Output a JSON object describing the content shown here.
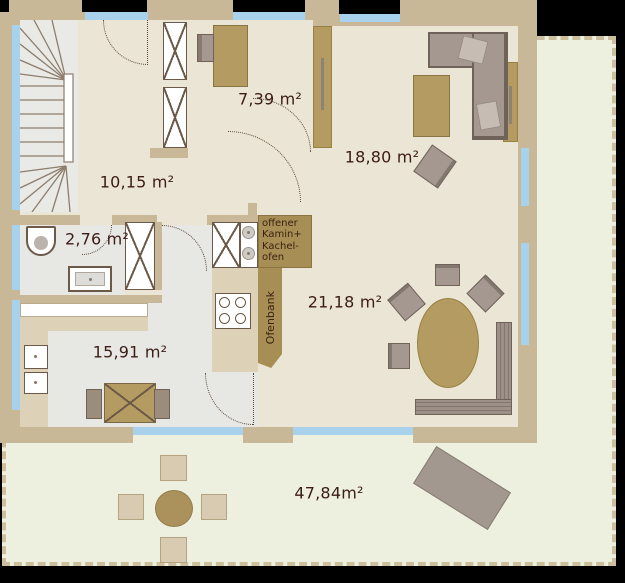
{
  "plan": {
    "title": "floor-plan",
    "rooms": [
      {
        "id": "hallway",
        "area_label": "10,15 m²"
      },
      {
        "id": "office",
        "area_label": "7,39 m²"
      },
      {
        "id": "living-room",
        "area_label": "18,80 m²"
      },
      {
        "id": "bathroom",
        "area_label": "2,76 m²"
      },
      {
        "id": "kitchen",
        "area_label": "15,91 m²"
      },
      {
        "id": "dining-room",
        "area_label": "21,18 m²"
      },
      {
        "id": "terrace",
        "area_label": "47,84m²"
      }
    ],
    "annotations": {
      "fireplace": "offener\nKamin+\nKachel-\nofen",
      "oven_bench": "Ofenbank"
    },
    "palette": {
      "wall": "#c9b897",
      "cream": "#eae5d4",
      "grayfloor": "#e7e8e4",
      "stair": "#e9e9e6",
      "blue": "#a8d2ec",
      "terrace": "#edf0de",
      "dash": "#cdbf9e",
      "tan": "#b39b61",
      "tanb": "#8a7442",
      "gray": "#a59890",
      "grayb": "#6f6359",
      "counter": "#ddd2b8",
      "fixture": "#6d5948",
      "fire": "#a78e55",
      "ink": "#3c1c15"
    }
  }
}
